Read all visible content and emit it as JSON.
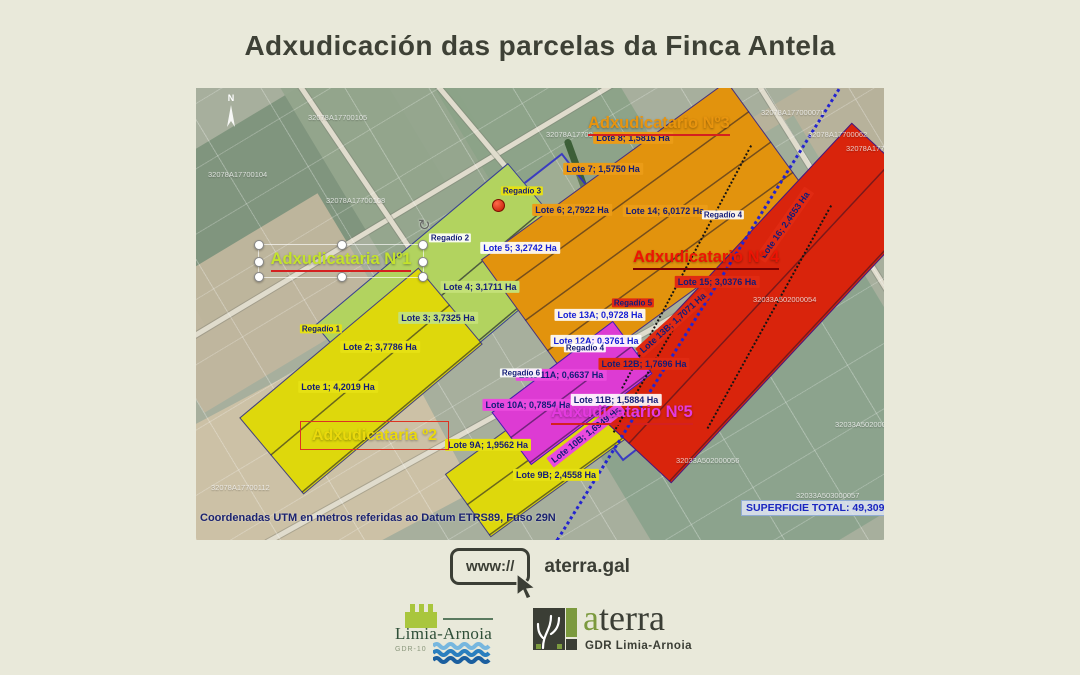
{
  "title": "Adxudicación das parcelas da Finca Antela",
  "map": {
    "north": "N",
    "adjudicators": [
      {
        "label": "Adxudicataria Nº1",
        "color": "#c3e22c"
      },
      {
        "label": "Adxudicataria º2",
        "color": "#ead90c"
      },
      {
        "label": "Adxudicatario Nº3",
        "color": "#e8940e"
      },
      {
        "label": "Adxudicatario Nº 4",
        "color": "#ed1404"
      },
      {
        "label": "Adxudicatario Nº5",
        "color": "#e43ae0"
      }
    ],
    "parcel_colors": {
      "adxudicataria_1": "#b2d35f",
      "adxudicataria_2": "#ded80c",
      "adxudicatario_3": "#e2930d",
      "adxudicatario_4": "#d9240c",
      "adxudicatario_5": "#dd3bd3"
    },
    "lots": [
      "Lote 1; 4,2019 Ha",
      "Lote 2; 3,7786 Ha",
      "Lote 3; 3,7325 Ha",
      "Lote 4; 3,1711 Ha",
      "Lote 5; 3,2742 Ha",
      "Lote 6; 2,7922 Ha",
      "Lote 7; 1,5750 Ha",
      "Lote 8; 1,5816 Ha",
      "Lote 9A; 1,9562 Ha",
      "Lote 9B; 2,4558 Ha",
      "Lote 10A; 0,7854 Ha",
      "Lote 10B; 1,6949 Ha",
      "Lote 11A; 0,6637 Ha",
      "Lote 11B; 1,5884 Ha",
      "Lote 12A; 0,3761 Ha",
      "Lote 12B; 1,7696 Ha",
      "Lote 13A; 0,9728 Ha",
      "Lote 13B; 1,7071 Ha",
      "Lote 14; 6,0172 Ha",
      "Lote 15; 3,0376 Ha",
      "Lote 16; 2,4653 Ha"
    ],
    "irrigation_points": [
      "Regadío 1",
      "Regadío 2",
      "Regadío 3",
      "Regadío 4",
      "Regadío 4",
      "Regadío 5",
      "Regadío 6"
    ],
    "cadastral_refs": [
      "32078A17700105",
      "32078A17700106",
      "32078A17700108",
      "32078A17700104",
      "32078A177000071",
      "32078A17700062",
      "32078A17700074",
      "32033A502000054",
      "32033A502000056",
      "32033A503000057",
      "32033A502000058",
      "32078A17700112"
    ],
    "coordinates_note": "Coordenadas UTM en metros referidas ao Datum ETRS89, Fuso 29N",
    "total_area": "SUPERFICIE TOTAL: 49,3099 Hectáreas"
  },
  "footer": {
    "url_prefix": "www://",
    "url": "aterra.gal",
    "logo_limia": {
      "name": "Limia-Arnoia",
      "sub": "GDR-10"
    },
    "logo_aterra": {
      "accent": "a",
      "rest": "terra",
      "sub": "GDR Limia-Arnoia"
    }
  }
}
